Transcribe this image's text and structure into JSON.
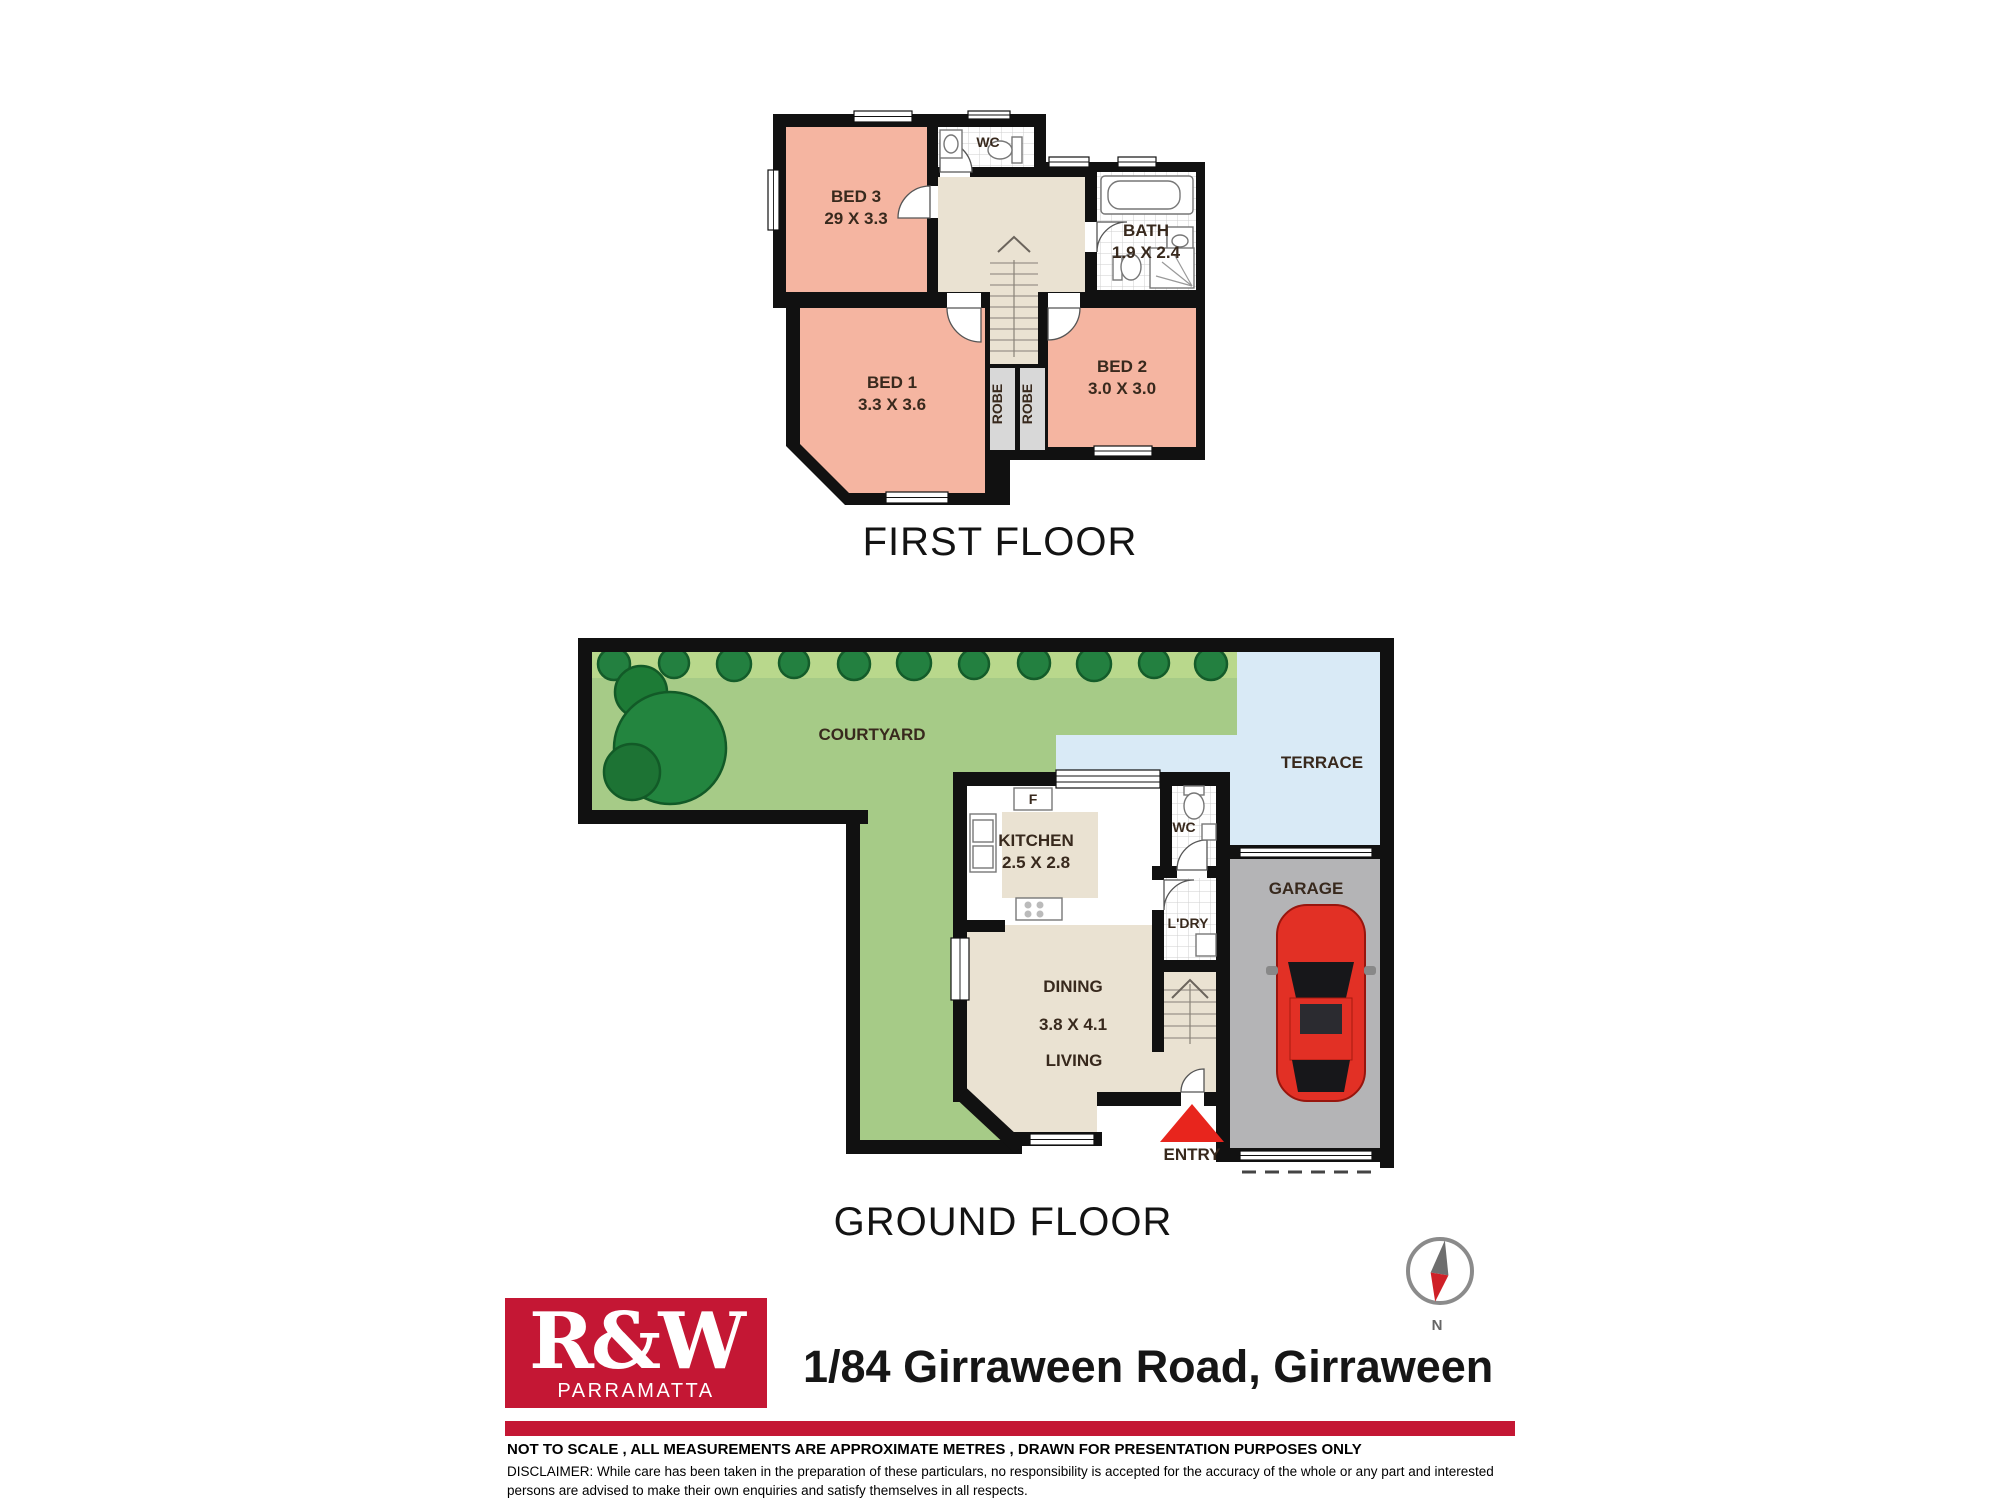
{
  "colors": {
    "wall": "#111111",
    "bedroom-pink": "#f5b5a1",
    "hall-beige": "#eae2d2",
    "courtyard-green": "#a6cb87",
    "terrace-blue": "#d9eaf6",
    "garage-gray": "#b4b4b6",
    "car-red": "#e23025",
    "entry-red": "#e8251d",
    "brand-red": "#c41734"
  },
  "first_floor": {
    "title": "FIRST FLOOR",
    "bed3_label": "BED 3",
    "bed3_dims": "29 X 3.3",
    "wc_label": "WC",
    "bath_label": "BATH",
    "bath_dims": "1.9 X 2.4",
    "bed1_label": "BED 1",
    "bed1_dims": "3.3 X 3.6",
    "bed2_label": "BED 2",
    "bed2_dims": "3.0 X 3.0",
    "robe_left_label": "ROBE",
    "robe_right_label": "ROBE"
  },
  "ground_floor": {
    "title": "GROUND FLOOR",
    "courtyard_label": "COURTYARD",
    "terrace_label": "TERRACE",
    "kitchen_label": "KITCHEN",
    "kitchen_dims": "2.5 X 2.8",
    "fridge_label": "F",
    "wc_label": "WC",
    "laundry_label": "L'DRY",
    "garage_label": "GARAGE",
    "dining_label": "DINING",
    "dining_dims": "3.8 X 4.1",
    "living_label": "LIVING",
    "entry_label": "ENTRY"
  },
  "compass": {
    "north_label": "N"
  },
  "footer": {
    "brand": "R&W",
    "brand_suburb": "PARRAMATTA",
    "address": "1/84 Girraween Road, Girraween",
    "scale_note": "NOT TO SCALE , ALL MEASUREMENTS ARE APPROXIMATE METRES , DRAWN FOR PRESENTATION PURPOSES ONLY",
    "disclaimer_line1": "DISCLAIMER:  While care has been taken in the preparation of these particulars, no responsibility is accepted for the accuracy of the whole or any part and interested",
    "disclaimer_line2": "persons are advised to make their own enquiries and satisfy  themselves in all respects."
  }
}
